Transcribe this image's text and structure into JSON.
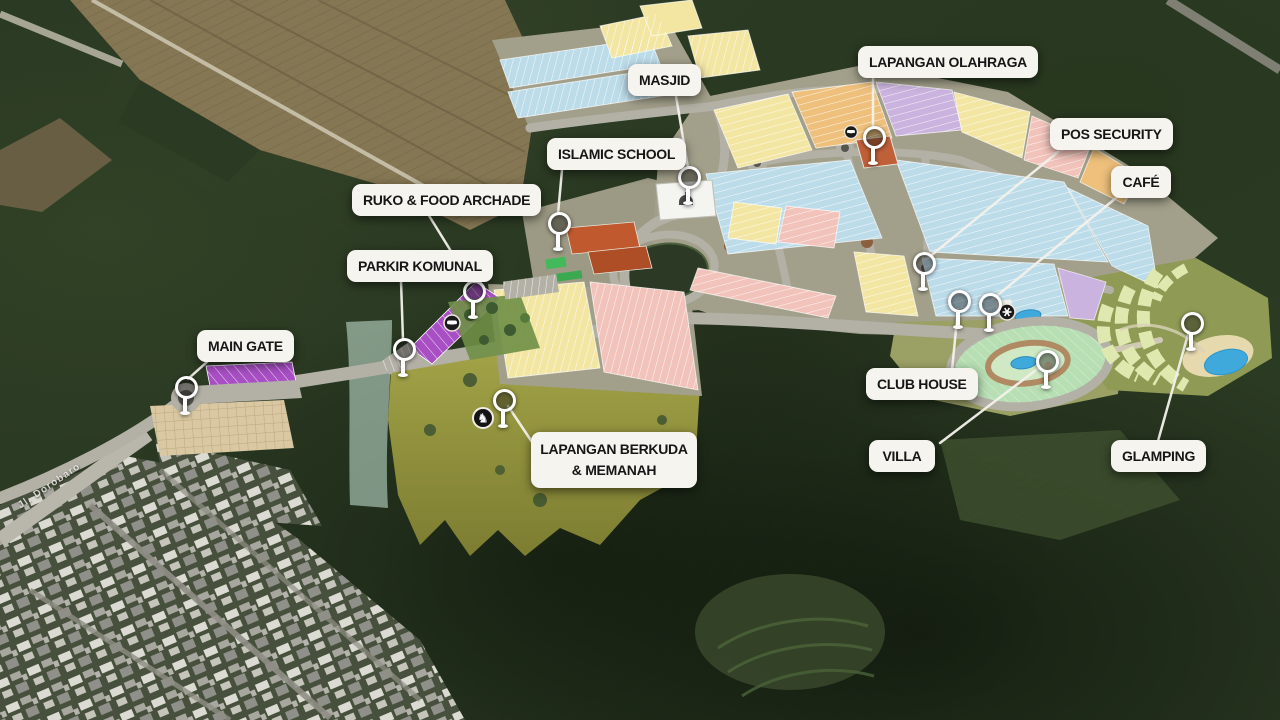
{
  "title": "Residential masterplan aerial site map",
  "road_label": "Jl. Dorobaro",
  "labels": [
    {
      "id": "masjid",
      "text": "MASJID"
    },
    {
      "id": "lapangan-olahraga",
      "text": "LAPANGAN OLAHRAGA"
    },
    {
      "id": "pos-security",
      "text": "POS SECURITY"
    },
    {
      "id": "cafe",
      "text": "CAFÉ"
    },
    {
      "id": "islamic-school",
      "text": "ISLAMIC SCHOOL"
    },
    {
      "id": "ruko-food-archade",
      "text": "RUKO & FOOD ARCHADE"
    },
    {
      "id": "parkir-komunal",
      "text": "PARKIR KOMUNAL"
    },
    {
      "id": "main-gate",
      "text": "MAIN GATE"
    },
    {
      "id": "lapangan-berkuda-memanah",
      "text": "LAPANGAN BERKUDA & MEMANAH"
    },
    {
      "id": "club-house",
      "text": "CLUB HOUSE"
    },
    {
      "id": "villa",
      "text": "VILLA"
    },
    {
      "id": "glamping",
      "text": "GLAMPING"
    }
  ],
  "palette": {
    "label_bg": "#f6f4ee",
    "label_text": "#161616",
    "leader_line": "#f4f2ec",
    "forest_dark": "#22301c",
    "forest_mid": "#33472a",
    "road_gray": "#b3b0a6",
    "plot_blue": "#bcdcea",
    "plot_yellow": "#f3e6a2",
    "plot_orange": "#eec07c",
    "plot_pink": "#f2c3ba",
    "plot_lavender": "#cab3de",
    "strip_purple": "#a84fc4",
    "villa_green": "#b7dfb3",
    "glamping_green": "#dfe8af",
    "field_olive": "#95973f",
    "creek_mint": "#cceadb",
    "water_blue": "#3fa9dc",
    "farm_tan": "#857753",
    "school_red": "#c05a2e",
    "checker_tan": "#d9c8a2"
  }
}
